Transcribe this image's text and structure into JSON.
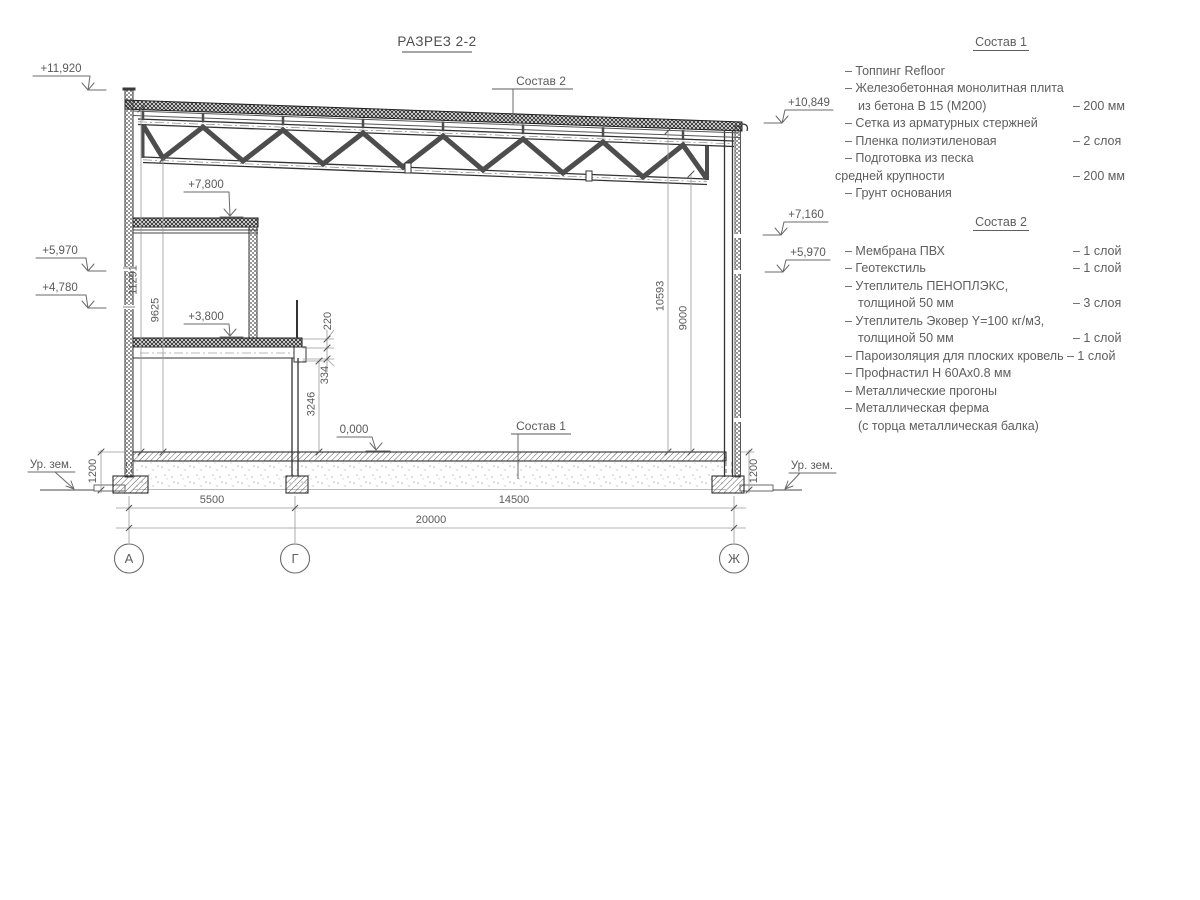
{
  "title": "РАЗРЕЗ 2-2",
  "colors": {
    "background": "#ffffff",
    "main_line": "#3a3a3a",
    "dim_line": "#9a9a9a",
    "text": "#5a5a5a"
  },
  "section": {
    "callouts": {
      "top": "Состав 2",
      "bottom": "Состав 1"
    },
    "elevations": {
      "left": [
        "+11,920",
        "+5,970",
        "+4,780"
      ],
      "right": [
        "+10,849",
        "+7,160",
        "+5,970"
      ],
      "inner": [
        "+7,800",
        "+3,800",
        "0,000"
      ],
      "ground_left": "Ур. зем.",
      "ground_right": "Ур. зем."
    },
    "dims": {
      "v11291": "11291",
      "v9625": "9625",
      "v10593": "10593",
      "v9000": "9000",
      "v220": "220",
      "v334": "334",
      "v3246": "3246",
      "v1200_left": "1200",
      "v1200_right": "1200",
      "h5500": "5500",
      "h14500": "14500",
      "h20000": "20000"
    },
    "axes": [
      "А",
      "Г",
      "Ж"
    ]
  },
  "spec1": {
    "title": "Состав 1",
    "items": [
      {
        "text": "– Топпинг Refloor",
        "value": ""
      },
      {
        "text": "– Железобетонная  монолитная плита",
        "value": ""
      },
      {
        "text": "из бетона В 15 (М200)",
        "value": "– 200 мм"
      },
      {
        "text": "– Сетка из арматурных стержней",
        "value": ""
      },
      {
        "text": "– Пленка полиэтиленовая",
        "value": "– 2 слоя"
      },
      {
        "text": "– Подготовка из песка",
        "value": ""
      },
      {
        "text": "средней крупности",
        "value": "– 200 мм"
      },
      {
        "text": "– Грунт основания",
        "value": ""
      }
    ]
  },
  "spec2": {
    "title": "Состав 2",
    "items": [
      {
        "text": "– Мембрана ПВХ",
        "value": "– 1 слой"
      },
      {
        "text": "– Геотекстиль",
        "value": "– 1 слой"
      },
      {
        "text": "– Утеплитель ПЕНОПЛЭКС,",
        "value": ""
      },
      {
        "text": "толщиной 50 мм",
        "value": "– 3 слоя"
      },
      {
        "text": "– Утеплитель Эковер Y=100 кг/м3,",
        "value": ""
      },
      {
        "text": "толщиной 50 мм",
        "value": "– 1 слой"
      },
      {
        "text": "– Пароизоляция для плоских кровель",
        "value": "– 1 слой"
      },
      {
        "text": "– Профнастил Н 60Ах0.8 мм",
        "value": ""
      },
      {
        "text": "– Металлические прогоны",
        "value": ""
      },
      {
        "text": "– Металлическая ферма",
        "value": ""
      },
      {
        "text": "(с торца металлическая балка)",
        "value": ""
      }
    ]
  }
}
